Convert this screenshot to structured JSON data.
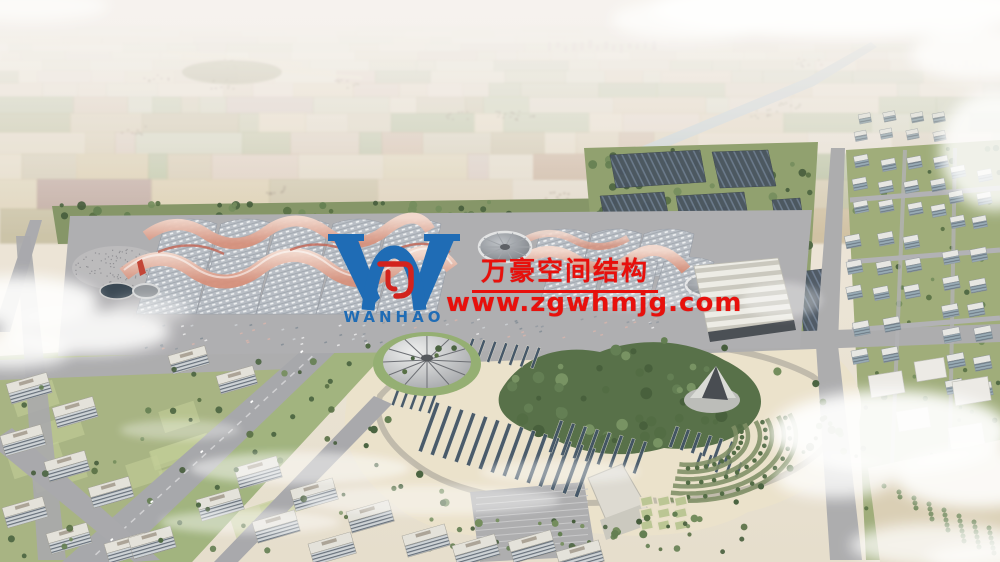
{
  "watermark": {
    "brand_cn": "万豪空间结构",
    "url": "www.zgwhmjg.com",
    "logo_text": "WANHAO",
    "text_color": "#e8100c",
    "logo_color": "#1f6cb5",
    "logo_mark_color": "#d2231e"
  },
  "palette": {
    "sky_haze": "#f2eee9",
    "farmland": "#cfc0a0",
    "canal": "#bac7ce",
    "tree_green": "#4c6639",
    "hall_roof": "#b5bbc3",
    "canopy_pink": "#d98f7c",
    "solar_panel": "#3d4957",
    "road_gray": "#a8a8ab",
    "park_ground": "#ebe1ca",
    "building_white": "#e3e1da",
    "cloud_white": "#ffffff"
  }
}
